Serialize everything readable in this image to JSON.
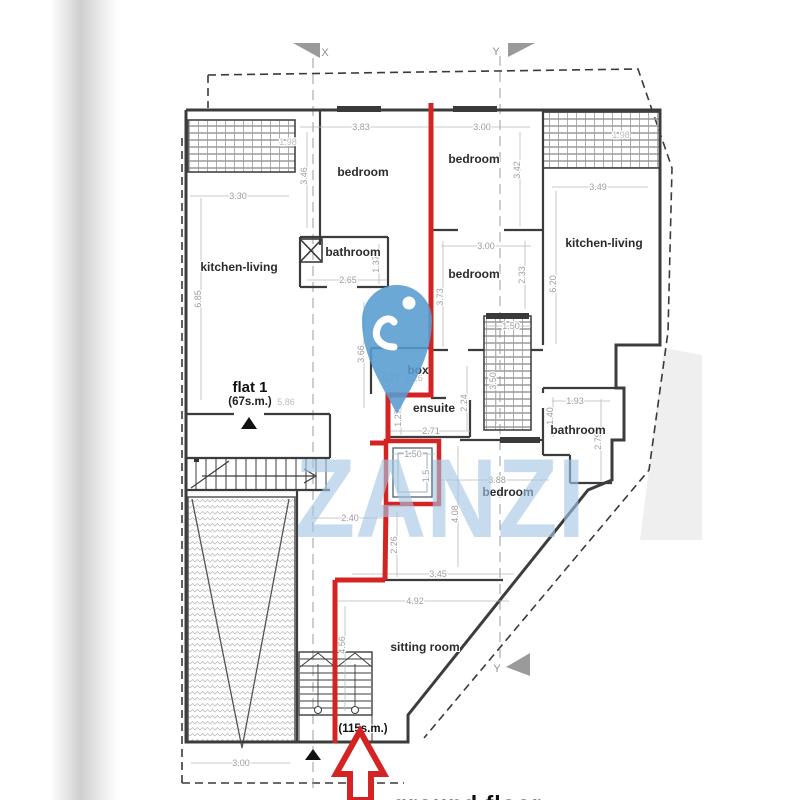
{
  "caption_partial": "ground floor",
  "watermark": {
    "text": "ZANZI",
    "pin_icon": "location-pin"
  },
  "colors": {
    "red_annotation": "#d42323",
    "watermark_blue": "rgba(163,198,228,0.62)",
    "pin_blue": "rgba(88,156,208,0.88)",
    "dim_grey": "#9d9d9d",
    "wall_dark": "#3c3c3c",
    "marker_grey": "#9a9a9a"
  },
  "section_markers": [
    {
      "label": "X",
      "x": 325,
      "y": 56
    },
    {
      "label": "Y",
      "x": 496,
      "y": 55
    },
    {
      "label": "Y",
      "x": 497,
      "y": 672
    }
  ],
  "labels": [
    {
      "t": "bedroom",
      "x": 363,
      "y": 176,
      "cls": "room"
    },
    {
      "t": "bedroom",
      "x": 474,
      "y": 163,
      "cls": "room"
    },
    {
      "t": "kitchen-living",
      "x": 239,
      "y": 271,
      "cls": "room"
    },
    {
      "t": "bathroom",
      "x": 353,
      "y": 256,
      "cls": "room"
    },
    {
      "t": "bedroom",
      "x": 474,
      "y": 278,
      "cls": "room"
    },
    {
      "t": "kitchen-living",
      "x": 604,
      "y": 247,
      "cls": "room"
    },
    {
      "t": "box",
      "x": 418,
      "y": 374,
      "cls": "room"
    },
    {
      "t": "ensuite",
      "x": 434,
      "y": 412,
      "cls": "room"
    },
    {
      "t": "bathroom",
      "x": 578,
      "y": 434,
      "cls": "room"
    },
    {
      "t": "bedroom",
      "x": 508,
      "y": 496,
      "cls": "room"
    },
    {
      "t": "sitting room",
      "x": 425,
      "y": 651,
      "cls": "room"
    },
    {
      "t": "flat 1",
      "x": 250,
      "y": 392,
      "cls": "flat"
    },
    {
      "t": "(67s.m.)",
      "x": 250,
      "y": 405,
      "cls": "flat-area"
    },
    {
      "t": "(115s.m.)",
      "x": 363,
      "y": 732,
      "cls": "area115"
    }
  ],
  "dimensions": [
    {
      "t": "3.83",
      "x": 361,
      "y": 130,
      "l": [
        300,
        127,
        428,
        127
      ]
    },
    {
      "t": "3.00",
      "x": 482,
      "y": 130,
      "l": [
        434,
        127,
        530,
        127
      ]
    },
    {
      "t": "1.98",
      "x": 288,
      "y": 145,
      "f": true
    },
    {
      "t": "1.98",
      "x": 621,
      "y": 138,
      "f": true
    },
    {
      "t": "3.46",
      "x": 307,
      "y": 176,
      "v": true,
      "l": [
        307,
        132,
        307,
        228
      ]
    },
    {
      "t": "3.42",
      "x": 520,
      "y": 170,
      "v": true,
      "l": [
        520,
        132,
        520,
        226
      ]
    },
    {
      "t": "3.49",
      "x": 598,
      "y": 190,
      "l": [
        552,
        187,
        648,
        187
      ]
    },
    {
      "t": "3.30",
      "x": 238,
      "y": 199,
      "l": [
        190,
        196,
        289,
        196
      ]
    },
    {
      "t": "3.00",
      "x": 486,
      "y": 249,
      "l": [
        441,
        246,
        531,
        246
      ]
    },
    {
      "t": "2.33",
      "x": 525,
      "y": 275,
      "v": true,
      "l": [
        525,
        241,
        525,
        309
      ]
    },
    {
      "t": "6.20",
      "x": 556,
      "y": 284,
      "v": true,
      "l": [
        556,
        191,
        556,
        344
      ]
    },
    {
      "t": "6.85",
      "x": 201,
      "y": 299,
      "v": true,
      "l": [
        201,
        198,
        201,
        400
      ]
    },
    {
      "t": "1.37",
      "x": 379,
      "y": 264,
      "v": true,
      "l": [
        379,
        244,
        379,
        284
      ]
    },
    {
      "t": "2.65",
      "x": 348,
      "y": 283,
      "l": [
        307,
        280,
        387,
        280
      ]
    },
    {
      "t": "3.73",
      "x": 443,
      "y": 297,
      "v": true,
      "l": [
        443,
        241,
        443,
        347
      ]
    },
    {
      "t": "3.66",
      "x": 364,
      "y": 354,
      "v": true,
      "l": [
        364,
        302,
        364,
        408
      ]
    },
    {
      "t": "1.50",
      "x": 511,
      "y": 329,
      "l": [
        486,
        326,
        531,
        326
      ]
    },
    {
      "t": "3.50",
      "x": 496,
      "y": 381,
      "v": true,
      "l": [
        496,
        322,
        496,
        424
      ]
    },
    {
      "t": "0.79",
      "x": 391,
      "y": 381,
      "f": true
    },
    {
      "t": "1.26",
      "x": 414,
      "y": 381,
      "f": true
    },
    {
      "t": "2.24",
      "x": 467,
      "y": 403,
      "v": true,
      "l": [
        467,
        366,
        467,
        431
      ]
    },
    {
      "t": "1.27",
      "x": 401,
      "y": 418,
      "v": true,
      "l": [
        401,
        399,
        401,
        435
      ]
    },
    {
      "t": "2.71",
      "x": 431,
      "y": 434,
      "l": [
        389,
        431,
        470,
        431
      ]
    },
    {
      "t": "1.93",
      "x": 575,
      "y": 404,
      "l": [
        552,
        401,
        610,
        401
      ]
    },
    {
      "t": "1.40",
      "x": 553,
      "y": 416,
      "v": true,
      "l": [
        553,
        397,
        553,
        437
      ]
    },
    {
      "t": "2.79",
      "x": 601,
      "y": 441,
      "v": true,
      "l": [
        601,
        399,
        601,
        481
      ]
    },
    {
      "t": "1.50",
      "x": 413,
      "y": 457,
      "l": [
        392,
        454,
        435,
        454
      ]
    },
    {
      "t": "1.5",
      "x": 429,
      "y": 476,
      "v": true
    },
    {
      "t": "3.88",
      "x": 497,
      "y": 483,
      "l": [
        436,
        480,
        549,
        480
      ]
    },
    {
      "t": "4.08",
      "x": 458,
      "y": 514,
      "v": true,
      "l": [
        458,
        446,
        458,
        567
      ]
    },
    {
      "t": "2.40",
      "x": 350,
      "y": 521,
      "l": [
        311,
        518,
        383,
        518
      ]
    },
    {
      "t": "2.26",
      "x": 397,
      "y": 545,
      "v": true,
      "l": [
        397,
        511,
        397,
        577
      ]
    },
    {
      "t": "3.45",
      "x": 438,
      "y": 577,
      "l": [
        352,
        574,
        514,
        574
      ]
    },
    {
      "t": "4.92",
      "x": 415,
      "y": 604,
      "l": [
        336,
        601,
        509,
        601
      ]
    },
    {
      "t": "4.56",
      "x": 345,
      "y": 645,
      "v": true,
      "l": [
        345,
        606,
        345,
        711
      ]
    },
    {
      "t": "3.00",
      "x": 241,
      "y": 766,
      "l": [
        191,
        763,
        290,
        763
      ]
    },
    {
      "t": "5.86",
      "x": 286,
      "y": 405,
      "f": true
    }
  ]
}
